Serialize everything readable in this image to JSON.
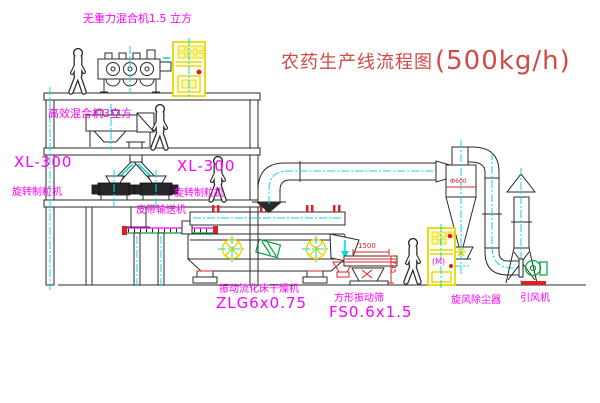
{
  "diagram": {
    "title": {
      "name": "农药生产线流程图",
      "capacity": "(500kg/h)"
    },
    "labels": {
      "gravity_mixer": "无重力混合机1.5 立方",
      "high_mixer": "高效混合机3立方",
      "xl300_left": {
        "model": "XL-300",
        "name": "旋转制粒机"
      },
      "xl300_right": {
        "model": "XL-300",
        "name": "旋转制粒机"
      },
      "belt_conveyor": "皮带输送机",
      "dryer": {
        "name": "振动流化床干燥机",
        "model": "ZLG6x0.75"
      },
      "sieve": {
        "name": "方形振动筛",
        "model": "FS0.6x1.5"
      },
      "cyclone": "旋风除尘器",
      "fan": "引风机",
      "elevator_motor": "(M)"
    },
    "dimensions": {
      "sieve_length": "1500",
      "sieve_height": "745",
      "cyclone_diameter": "Ф600"
    },
    "colors": {
      "label": "#ff00ff",
      "title": "#d24a43",
      "equipment_yellow": "#e8d800",
      "pipe_centerline": "#00dddd",
      "detail_red": "#e02020",
      "detail_green": "#00a33c",
      "line": "#2a2a2a"
    }
  }
}
